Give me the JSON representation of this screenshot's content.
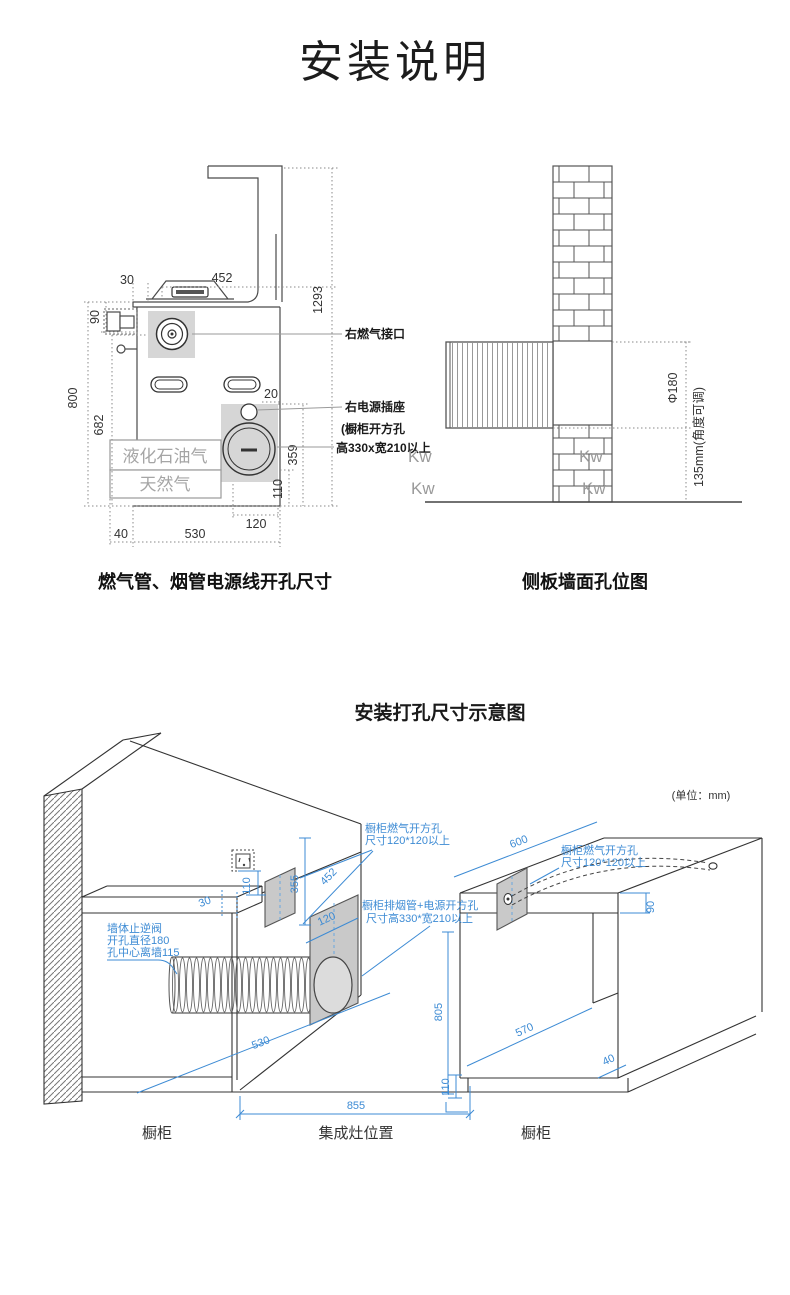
{
  "page": {
    "title": "安装说明",
    "unit_note": "(单位：mm)"
  },
  "colors": {
    "accent_blue": "#3d8bd4",
    "panel_gray": "#c9c9c9",
    "label_gray": "#a5a5a5"
  },
  "front_diagram": {
    "caption": "燃气管、烟管电源线开孔尺寸",
    "callouts": {
      "gas_inlet": "右燃气接口",
      "power_socket": "右电源插座",
      "cabinet_hole_line1": "(橱柜开方孔",
      "cabinet_hole_line2": "高330x宽210以上"
    },
    "gas_type_top": "液化石油气",
    "gas_type_bottom": "天然气",
    "dims": {
      "top_width": "452",
      "left_offset": "30",
      "valve_drop": "90",
      "total_height": "1293",
      "counter_height": "800",
      "inlet_height": "682",
      "panel_offset": "20",
      "panel_height": "359",
      "panel_bottom": "110",
      "panel_width": "120",
      "left_gap": "40",
      "depth": "530"
    }
  },
  "side_diagram": {
    "caption": "侧板墙面孔位图",
    "hole_diameter": "Φ180",
    "height_note": "135mm(角度可调)",
    "watermarks": [
      "Kw",
      "Kw",
      "Kw",
      "Kw"
    ]
  },
  "iso_diagram": {
    "title": "安装打孔尺寸示意图",
    "annotations": {
      "gas_hole_left_line1": "橱柜燃气开方孔",
      "gas_hole_left_line2": "尺寸120*120以上",
      "gas_hole_right_line1": "橱柜燃气开方孔",
      "gas_hole_right_line2": "尺寸120*120以上",
      "flue_hole_line1": "橱柜排烟管+电源开方孔",
      "flue_hole_line2": "尺寸高330*宽210以上",
      "valve_line1": "墙体止逆阀",
      "valve_line2": "开孔直径180",
      "valve_line3": "孔中心离墙115"
    },
    "dims": {
      "counter_side": "30",
      "socket_gap": "110",
      "hole_height": "355",
      "width_452": "452",
      "hole_120": "120",
      "depth_530": "530",
      "gap_width": "855",
      "counter_h": "805",
      "kick_h": "110",
      "right_depth": "600",
      "right_inner": "570",
      "counter_thick": "90",
      "kick_offset": "40"
    },
    "captions": {
      "left": "橱柜",
      "middle": "集成灶位置",
      "right": "橱柜"
    }
  }
}
